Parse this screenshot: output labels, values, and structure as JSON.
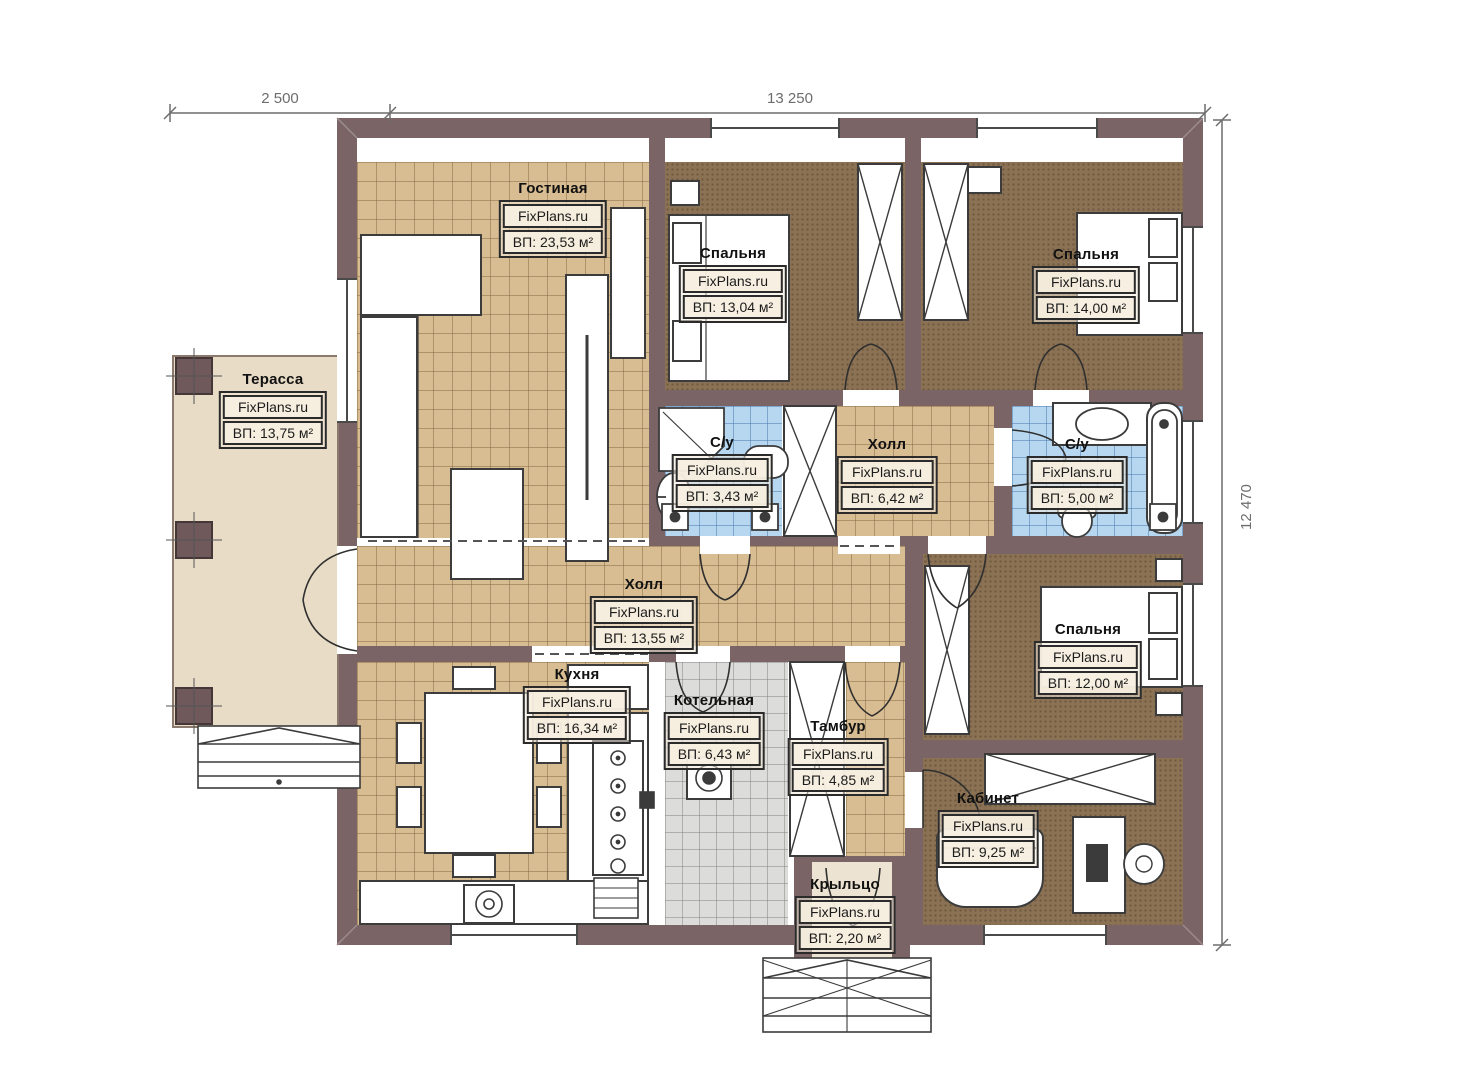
{
  "plan": {
    "watermark": "FixPlans.ru",
    "dimensions": {
      "terrace_width": "2 500",
      "house_width": "13 250",
      "house_depth": "12 470"
    },
    "rooms": {
      "living": {
        "name": "Гостиная",
        "area": "ВП: 23,53 м²"
      },
      "bedroom1": {
        "name": "Спальня",
        "area": "ВП: 13,04 м²"
      },
      "bedroom2": {
        "name": "Спальня",
        "area": "ВП: 14,00 м²"
      },
      "terrace": {
        "name": "Терасса",
        "area": "ВП: 13,75 м²"
      },
      "bath1": {
        "name": "С/у",
        "area": "ВП: 3,43 м²"
      },
      "hall_small": {
        "name": "Холл",
        "area": "ВП: 6,42 м²"
      },
      "bath2": {
        "name": "С/у",
        "area": "ВП: 5,00 м²"
      },
      "hall_main": {
        "name": "Холл",
        "area": "ВП: 13,55 м²"
      },
      "bedroom3": {
        "name": "Спальня",
        "area": "ВП: 12,00 м²"
      },
      "kitchen": {
        "name": "Кухня",
        "area": "ВП: 16,34 м²"
      },
      "boiler": {
        "name": "Котельная",
        "area": "ВП: 6,43 м²"
      },
      "vestibule": {
        "name": "Тамбур",
        "area": "ВП: 4,85 м²"
      },
      "office": {
        "name": "Кабинет",
        "area": "ВП: 9,25 м²"
      },
      "porch": {
        "name": "Крыльцо",
        "area": "ВП: 2,20 м²"
      }
    },
    "colors": {
      "wall": "#7b6466",
      "floor_tan": "#d8bc92",
      "floor_brown": "#8c7254",
      "floor_blue": "#b7d7f0",
      "floor_gray": "#dcdcda",
      "floor_terrace": "#e8dcc6"
    }
  }
}
